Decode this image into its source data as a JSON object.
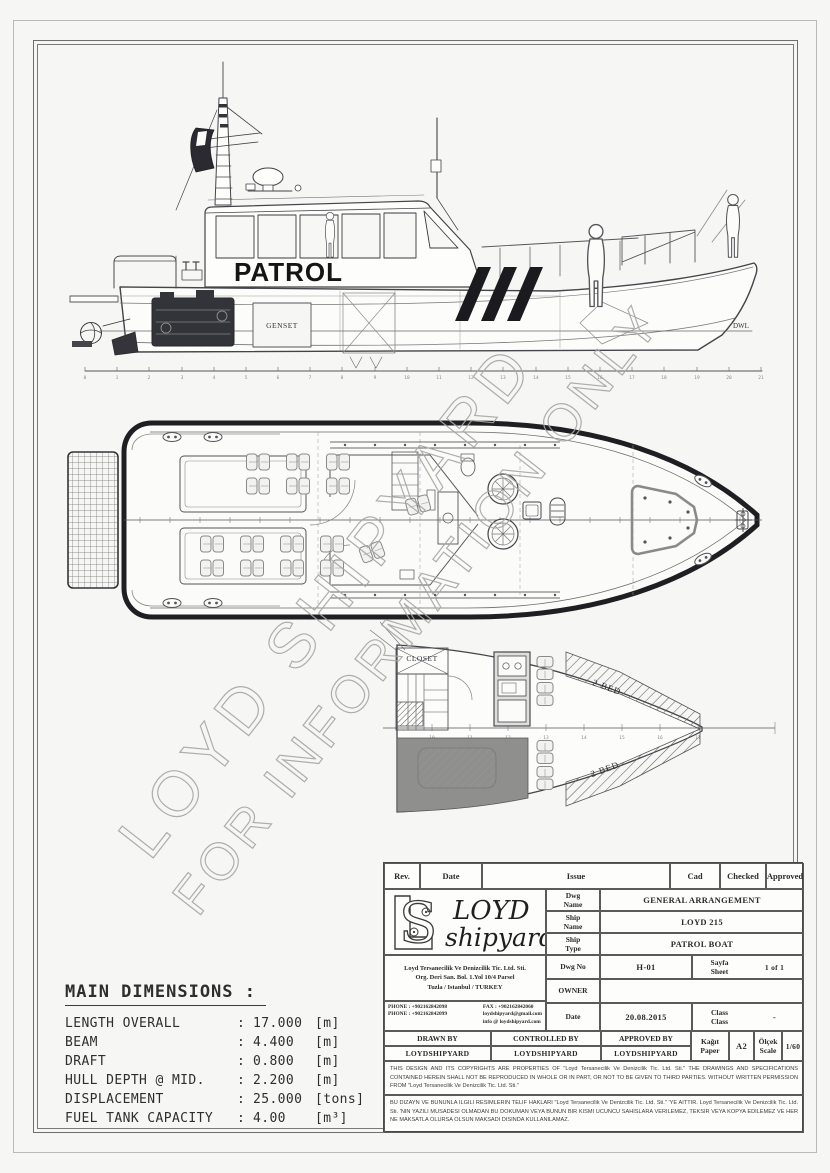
{
  "watermark": {
    "line1": "LOYD SHIPYARD",
    "line2": "FOR INFORMATION ONLY"
  },
  "profile": {
    "boat_name": "PATROL",
    "genset": "GENSET",
    "dwl": "DWL",
    "stations": [
      "0",
      "1",
      "2",
      "3",
      "4",
      "5",
      "6",
      "7",
      "8",
      "9",
      "10",
      "11",
      "12",
      "13",
      "14",
      "15",
      "16",
      "17",
      "18",
      "19",
      "20",
      "21"
    ]
  },
  "lower_deck": {
    "closet": "CLOSET",
    "bed_upper": "2 BED",
    "bed_lower": "2 BED",
    "stations": [
      "10",
      "11",
      "12",
      "13",
      "14",
      "15",
      "16",
      "17"
    ]
  },
  "main_dimensions": {
    "title": "MAIN DIMENSIONS :",
    "sep": ":",
    "rows": [
      {
        "label": "LENGTH OVERALL",
        "value": "17.000",
        "unit": "[m]"
      },
      {
        "label": "BEAM",
        "value": "4.400",
        "unit": "[m]"
      },
      {
        "label": "DRAFT",
        "value": "0.800",
        "unit": "[m]"
      },
      {
        "label": "HULL DEPTH @ MID.",
        "value": "2.200",
        "unit": "[m]"
      },
      {
        "label": "DISPLACEMENT",
        "value": "25.000",
        "unit": "[tons]"
      },
      {
        "label": "FUEL TANK CAPACITY",
        "value": "4.00",
        "unit": "[m³]"
      }
    ]
  },
  "title_block": {
    "header": {
      "rev": "Rev.",
      "date": "Date",
      "issue": "Issue",
      "cad": "Cad",
      "checked": "Checked",
      "approved": "Approved"
    },
    "logo": {
      "monogram": "S",
      "name_line1": "LOYD",
      "name_line2": "shipyard"
    },
    "company": {
      "address1": "Loyd Tersanecilik Ve Denizcilik  Tic.  Ltd. Sti.",
      "address2": "Org. Deri San. Bol. 1.Yol 10/4 Parsel",
      "address3": "Tuzla / Istanbul / TURKEY",
      "phone1": "PHONE : +902162842098",
      "phone2": "PHONE : +902162842099",
      "fax": "FAX : +902162842060",
      "email1": "loydshipyard@gmail.com",
      "email2": "info @ loydshipyard.com"
    },
    "fields": {
      "dwg_name_label": "Dwg\nName",
      "dwg_name": "GENERAL ARRANGEMENT",
      "ship_name_label": "Ship\nName",
      "ship_name": "LOYD 215",
      "ship_type_label": "Ship\nType",
      "ship_type": "PATROL BOAT",
      "dwg_no_label": "Dwg No",
      "dwg_no": "H-01",
      "sheet_label": "Sayfa\nSheet",
      "sheet_value": "1 of 1",
      "owner_label": "OWNER",
      "owner_value": "",
      "date_label": "Date",
      "date_value": "20.08.2015",
      "class_label": "Class\nClass",
      "class_value": "-",
      "paper_label": "Kağıt\nPaper",
      "paper_value": "A2",
      "scale_label": "Ölçek\nScale",
      "scale_value": "1/60"
    },
    "signatures": {
      "drawn_label": "DRAWN BY",
      "drawn_value": "LOYDSHIPYARD",
      "controlled_label": "CONTROLLED BY",
      "controlled_value": "LOYDSHIPYARD",
      "approved_label": "APPROVED BY",
      "approved_value": "LOYDSHIPYARD"
    },
    "disclaimer_en": "THIS DESIGN AND ITS COPYRIGHTS ARE PROPERTIES OF \"Loyd Tersanecilik Ve Denizcilik Tic. Ltd. Sti.\" THE DRAWINGS AND SPECIFICATIONS CONTAINED HEREIN SHALL NOT BE REPRODUCED IN WHOLE OR IN PART, OR NOT TO BE GIVEN TO THIRD PARTIES.   WITHOUT WRITTEN PERMISSION FROM \"Loyd Tersanecilik Ve Denizcilik Tic. Ltd. Sti.\"",
    "disclaimer_tr": "BU DIZAYN VE BUNUNLA ILGILI RESIMLERIN TELIF HAKLARI \"Loyd Tersanecilik Ve Denizcilik Tic. Ltd. Sti.\" 'YE AITTIR. Loyd Tersanecilik Ve Denizcilik Tic. Ltd. Sti. 'NIN YAZILI MUSADESI OLMADAN BU DOKUMAN VEYA BUNUN BIR KISMI UCUNCU SAHISLARA VERILEMEZ, TEKSIR VEYA KOPYA EDILEMEZ VE HER NE MAKSATLA OLURSA OLSUN MAKSADI DISINDA KULLANILAMAZ."
  }
}
